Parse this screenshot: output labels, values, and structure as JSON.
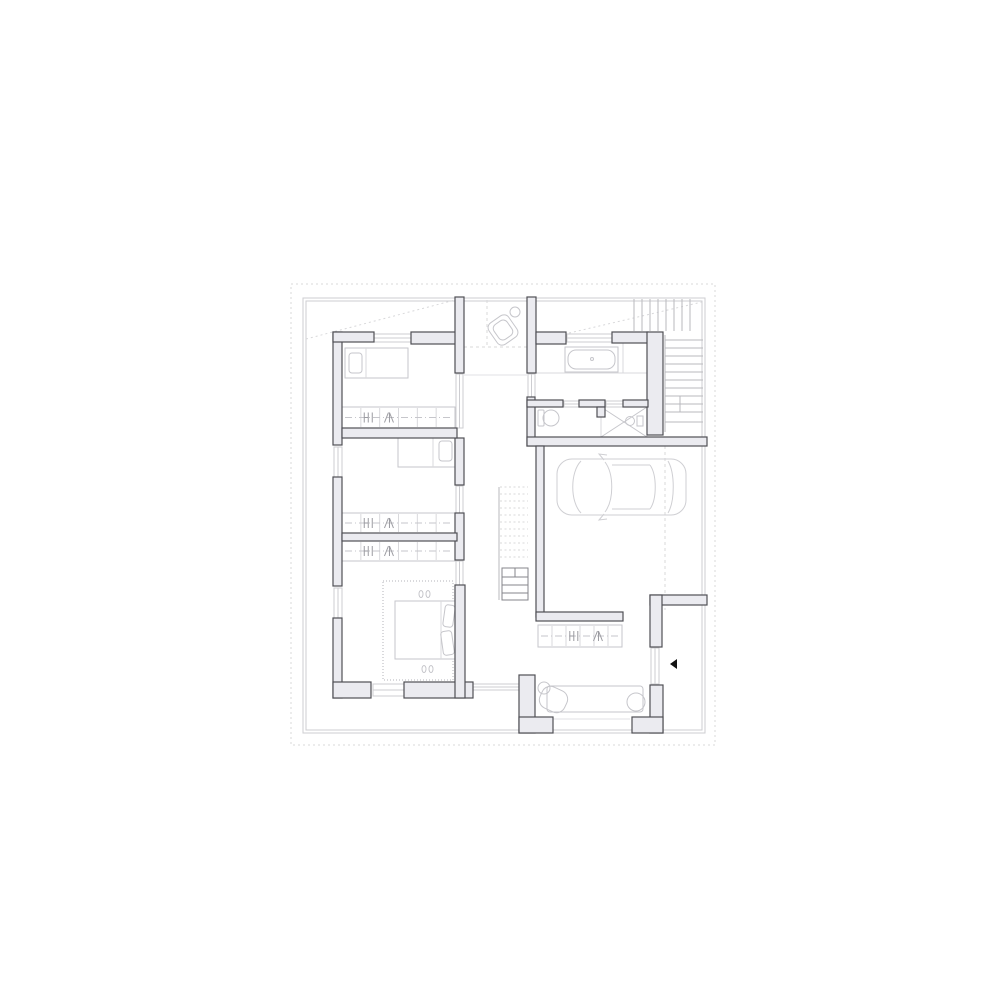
{
  "plan": {
    "colors": {
      "background": "#ffffff",
      "wall_fill": "#ebebf0",
      "wall_stroke": "#4f4f55",
      "furniture": "#c6c6cb",
      "furniture_light": "#d9d9dc",
      "glyph": "#9a9aa0",
      "boundary": "#cdcdd1",
      "dotted": "#d8d8da",
      "stair": "#b9b9be",
      "stair_dark": "#85858b",
      "arrow": "#141414"
    },
    "boundary": {
      "dotted": [
        291,
        284,
        424,
        461
      ],
      "outer": [
        303,
        298,
        402,
        435
      ],
      "inner": [
        306,
        301,
        396,
        429
      ],
      "diagonals": [
        [
          306,
          339,
          455,
          300
        ],
        [
          535,
          341,
          702,
          302
        ]
      ]
    },
    "walls": [
      [
        333,
        332,
        9,
        113
      ],
      [
        333,
        477,
        9,
        109
      ],
      [
        333,
        618,
        9,
        80
      ],
      [
        333,
        682,
        38,
        16
      ],
      [
        404,
        682,
        69,
        16
      ],
      [
        333,
        332,
        41,
        10
      ],
      [
        411,
        332,
        46,
        12
      ],
      [
        455,
        297,
        9,
        76
      ],
      [
        455,
        438,
        9,
        47
      ],
      [
        455,
        513,
        9,
        47
      ],
      [
        455,
        585,
        10,
        113
      ],
      [
        342,
        428,
        115,
        10
      ],
      [
        342,
        533,
        115,
        8
      ],
      [
        527,
        297,
        9,
        76
      ],
      [
        527,
        397,
        8,
        49
      ],
      [
        536,
        332,
        30,
        12
      ],
      [
        612,
        332,
        36,
        11
      ],
      [
        647,
        332,
        16,
        103
      ],
      [
        527,
        400,
        36,
        7
      ],
      [
        579,
        400,
        26,
        7
      ],
      [
        597,
        407,
        8,
        10
      ],
      [
        623,
        400,
        25,
        7
      ],
      [
        527,
        437,
        180,
        9
      ],
      [
        536,
        446,
        8,
        171
      ],
      [
        536,
        612,
        87,
        9
      ],
      [
        650,
        595,
        57,
        10
      ],
      [
        650,
        595,
        12,
        52
      ],
      [
        519,
        675,
        16,
        58
      ],
      [
        519,
        717,
        34,
        16
      ],
      [
        650,
        685,
        13,
        48
      ],
      [
        632,
        717,
        31,
        16
      ]
    ],
    "windows": [
      [
        374,
        334,
        37,
        8
      ],
      [
        567,
        334,
        45,
        8
      ],
      [
        334,
        447,
        8,
        30
      ],
      [
        334,
        588,
        8,
        30
      ],
      [
        373,
        684,
        31,
        12
      ],
      [
        456,
        374,
        7,
        54
      ],
      [
        456,
        486,
        7,
        27
      ],
      [
        456,
        561,
        7,
        24
      ],
      [
        528,
        374,
        7,
        23
      ],
      [
        564,
        401,
        15,
        6
      ],
      [
        606,
        401,
        17,
        6
      ],
      [
        651,
        648,
        8,
        36
      ],
      [
        472,
        684,
        47,
        6
      ]
    ],
    "wardrobes": [
      {
        "x": 342,
        "y": 407,
        "w": 113,
        "h": 21,
        "gx": [
          0.25,
          0.42
        ]
      },
      {
        "x": 342,
        "y": 513,
        "w": 113,
        "h": 20,
        "gx": [
          0.25,
          0.42
        ]
      },
      {
        "x": 342,
        "y": 541,
        "w": 113,
        "h": 20,
        "gx": [
          0.25,
          0.42
        ]
      },
      {
        "x": 538,
        "y": 625,
        "w": 84,
        "h": 22,
        "gx": [
          0.45,
          0.72
        ]
      }
    ],
    "stairs": {
      "upper_vertical": {
        "x_start": 634,
        "x_end": 690,
        "step": 8,
        "y1": 299,
        "y2": 331
      },
      "right_treads": {
        "y_start": 340,
        "y_end": 412,
        "step": 8,
        "x1": 665,
        "x2": 703
      },
      "right_rail": [
        665,
        335,
        665,
        432
      ],
      "right_extra": [
        [
          680,
          396,
          680,
          412
        ],
        [
          665,
          412,
          703,
          412
        ],
        [
          665,
          422,
          703,
          422
        ]
      ],
      "hall_dashed": {
        "y_start": 487,
        "y_end": 562,
        "step": 7,
        "x1": 500,
        "x2": 528
      },
      "hall_rail": [
        499,
        487,
        499,
        600
      ],
      "solid_box": [
        502,
        568,
        26,
        32
      ],
      "solid_treads": [
        577,
        585,
        593
      ],
      "tick": [
        515,
        568,
        515,
        577
      ]
    },
    "fixtures": {
      "basin": {
        "cx": 503,
        "cy": 330,
        "rot": -35,
        "outer": [
          491,
          317,
          24,
          26
        ],
        "inner": [
          495,
          321,
          16,
          18
        ],
        "circle": [
          515,
          312,
          5
        ]
      },
      "bathtub": {
        "outer": [
          565,
          347,
          53,
          25
        ],
        "inner": [
          568,
          350,
          47,
          19
        ],
        "drain": [
          592,
          359
        ]
      },
      "bath_lines": [
        [
          536,
          373,
          648,
          373
        ],
        [
          623,
          332,
          623,
          373
        ]
      ],
      "toilet": {
        "tank": [
          538,
          410,
          6,
          16
        ],
        "bowl": [
          551,
          418,
          8,
          8
        ]
      },
      "shower": {
        "rect": [
          601,
          407,
          46,
          30
        ],
        "head": [
          630,
          421,
          4.5
        ],
        "box": [
          637,
          416,
          6,
          10
        ]
      },
      "dash_lines": [
        [
          665,
          446,
          665,
          610
        ],
        [
          487,
          300,
          487,
          347
        ],
        [
          464,
          347,
          527,
          347
        ]
      ],
      "light_lines": [
        [
          548,
          719,
          630,
          719
        ],
        [
          464,
          375,
          527,
          375
        ]
      ]
    },
    "furniture": {
      "bed1": {
        "rect": [
          345,
          348,
          63,
          30
        ],
        "pillow": [
          349,
          353,
          13,
          20
        ],
        "line": [
          366,
          348,
          366,
          378
        ]
      },
      "bed2": {
        "rect": [
          398,
          437,
          57,
          30
        ],
        "pillow": [
          439,
          441,
          13,
          20
        ],
        "line": [
          433,
          437,
          433,
          467
        ]
      },
      "master": {
        "rug": [
          383,
          581,
          70,
          99
        ],
        "bed": [
          395,
          601,
          60,
          58
        ],
        "lines": [
          [
            441,
            601,
            441,
            659
          ]
        ],
        "pillows": [
          [
            444,
            605,
            10,
            22,
            8
          ],
          [
            442,
            631,
            11,
            24,
            -8
          ]
        ],
        "slippers": [
          [
            421,
            594
          ],
          [
            428,
            594
          ],
          [
            424,
            669
          ],
          [
            431,
            669
          ]
        ]
      },
      "car": {
        "x": 557,
        "y": 458,
        "w": 129,
        "h": 58
      },
      "bench": {
        "rect": [
          547,
          686,
          96,
          26
        ],
        "circle": [
          636,
          702,
          9
        ],
        "side_circle": [
          544,
          688,
          6
        ],
        "chair": [
          540,
          688,
          27,
          23,
          25
        ]
      }
    },
    "entry_arrow": [
      [
        677,
        659
      ],
      [
        670,
        664
      ],
      [
        677,
        669
      ]
    ]
  }
}
